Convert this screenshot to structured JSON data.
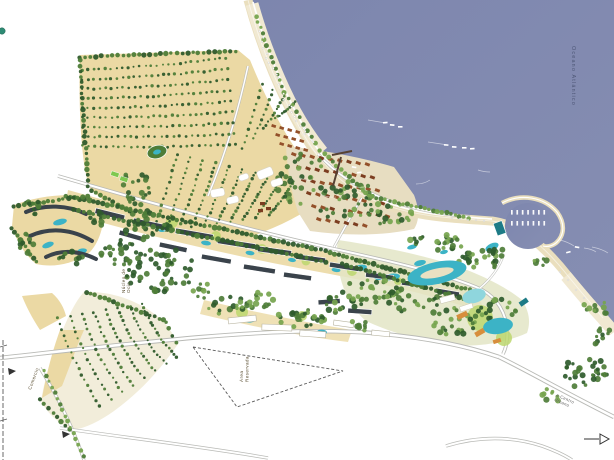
{
  "labels": {
    "ocean": "Oceano Atlántico",
    "reserved_area": [
      "Área",
      "Reservada"
    ],
    "commerce": "Comercio",
    "leisure": [
      "Núcleo de",
      "Ocio"
    ],
    "road": [
      "a Centro",
      "Urbano"
    ]
  },
  "colors": {
    "sea": "#8189b1",
    "sea_light": "#8a92b6",
    "sand": "#eadfbe",
    "beach_light": "#f1e9d2",
    "villa_tan": "#ebd9a4",
    "villa_cream": "#f2edda",
    "village_base": "#e7ddc1",
    "resort_base": "#e3e5c5",
    "tree_dark": "#2f5b2c",
    "tree_mid": "#4e7d38",
    "tree_light": "#76a44e",
    "lawn": "#bcd76f",
    "court_green": "#7ec850",
    "roof_brown": "#7c3d20",
    "roof_red": "#93502a",
    "building_dark": "#3a434b",
    "building_white": "#ffffff",
    "pool": "#3cb3c6",
    "pool_light": "#8fd6dd",
    "road_casing": "#b9bab6",
    "road_fill": "#ffffff",
    "pier": "#564233",
    "boundary": "#5a5a5a",
    "teal": "#1d7b86",
    "orange": "#d78e3c",
    "legend_dot": "#2e8b74"
  }
}
